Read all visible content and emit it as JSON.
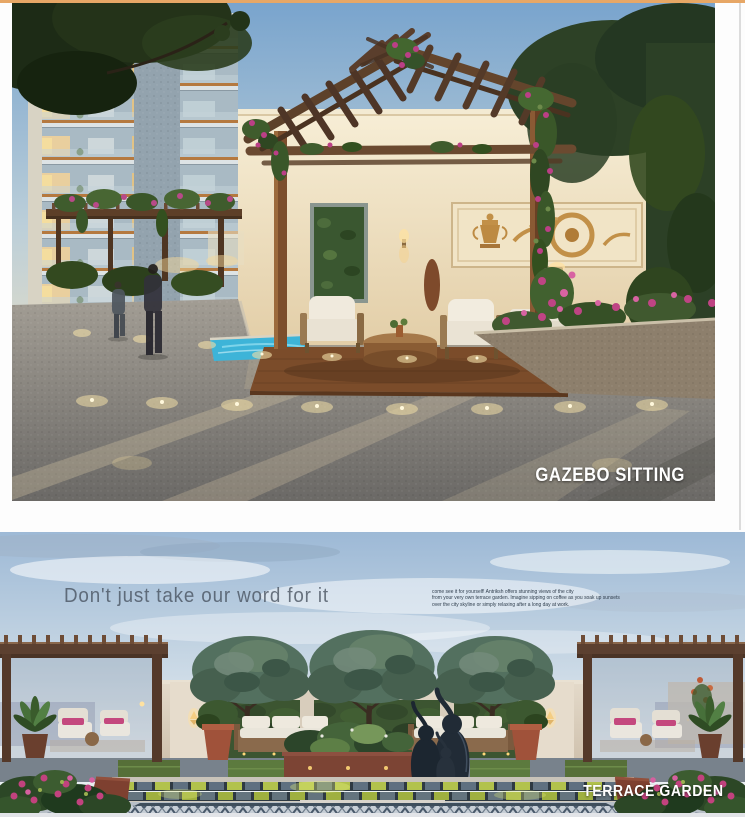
{
  "page": {
    "top_bar_color": "#e7a766",
    "background": "#fdfdfd",
    "edge_line_color": "#dcdcdc",
    "footer_strip_color": "#e2e4e8"
  },
  "gazebo_section": {
    "caption": "GAZEBO SITTING"
  },
  "terrace_section": {
    "heading": "Don't just take our word for it",
    "body_lines": [
      "come see it for yourself! Antriksh offers stunning views of the city",
      "from your very own terrace garden. Imagine sipping on coffee as you soak up sunsets",
      "over the city skyline or simply relaxing after a long day at work."
    ],
    "caption": "TERRACE GARDEN"
  },
  "palette": {
    "caption_text": "#ffffff",
    "heading_text": "#46515e",
    "body_text": "#2f3d4c",
    "sky_blue": "#79a4cd",
    "wall_cream": "#eedfbf",
    "wood_brown": "#6b4a30",
    "pool_cyan": "#3db4d8",
    "bougainvillea_pink": "#bb3f86",
    "foliage_green": "#2e4426",
    "pavement_gray": "#8e8b86",
    "checker_lime": "#b2c24c"
  }
}
